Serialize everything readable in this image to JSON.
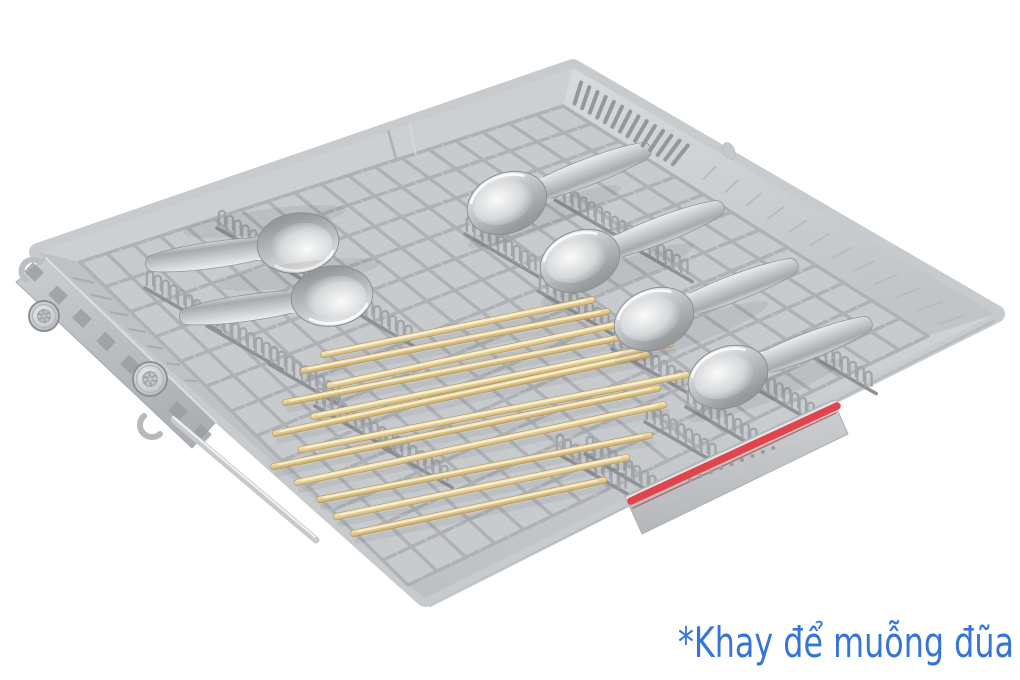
{
  "caption": {
    "text": "*Khay để muỗng đũa"
  },
  "scene": {
    "subject": "dishwasher-cutlery-tray",
    "label": "Cutlery tray (third rack) holding metal soup spoons and wooden chopsticks",
    "spoon_count": 6,
    "chopstick_count": 12,
    "wheel_count": 2,
    "handle_dot_count": 9
  },
  "colors": {
    "background": "#FFFFFF",
    "caption_blue": "#3575D6",
    "accent_red": "#E2444B",
    "accent_red_dark": "#B03038",
    "tray_plastic": "#C8CBCE",
    "tray_back": "#CDD0D3",
    "tray_right_light": "#D8DADB",
    "tray_right_dark": "#C2C5C8",
    "tray_front_light": "#D3D5D7",
    "tray_front_dark": "#BDC0C3",
    "tray_left": "#BEC1C5",
    "inner_edge": "#A2A5A9",
    "grid_wire": "#AEB2B6",
    "grid_wire_fine": "#C6C9CC",
    "comb_gray": "#A1A5A9",
    "comb_base": "#8E9296",
    "slot_gray": "#94989C",
    "rib_gray": "#B9BCBF",
    "rail_light": "#CBCED1",
    "rail_dark": "#ACAFB3",
    "metal_light": "#F2F3F4",
    "metal_mid": "#C6C9CC",
    "metal_dark": "#95999C",
    "wood_light": "#F7EECB",
    "wood_mid": "#EDDCA6",
    "wood_dark": "#CDB173"
  }
}
